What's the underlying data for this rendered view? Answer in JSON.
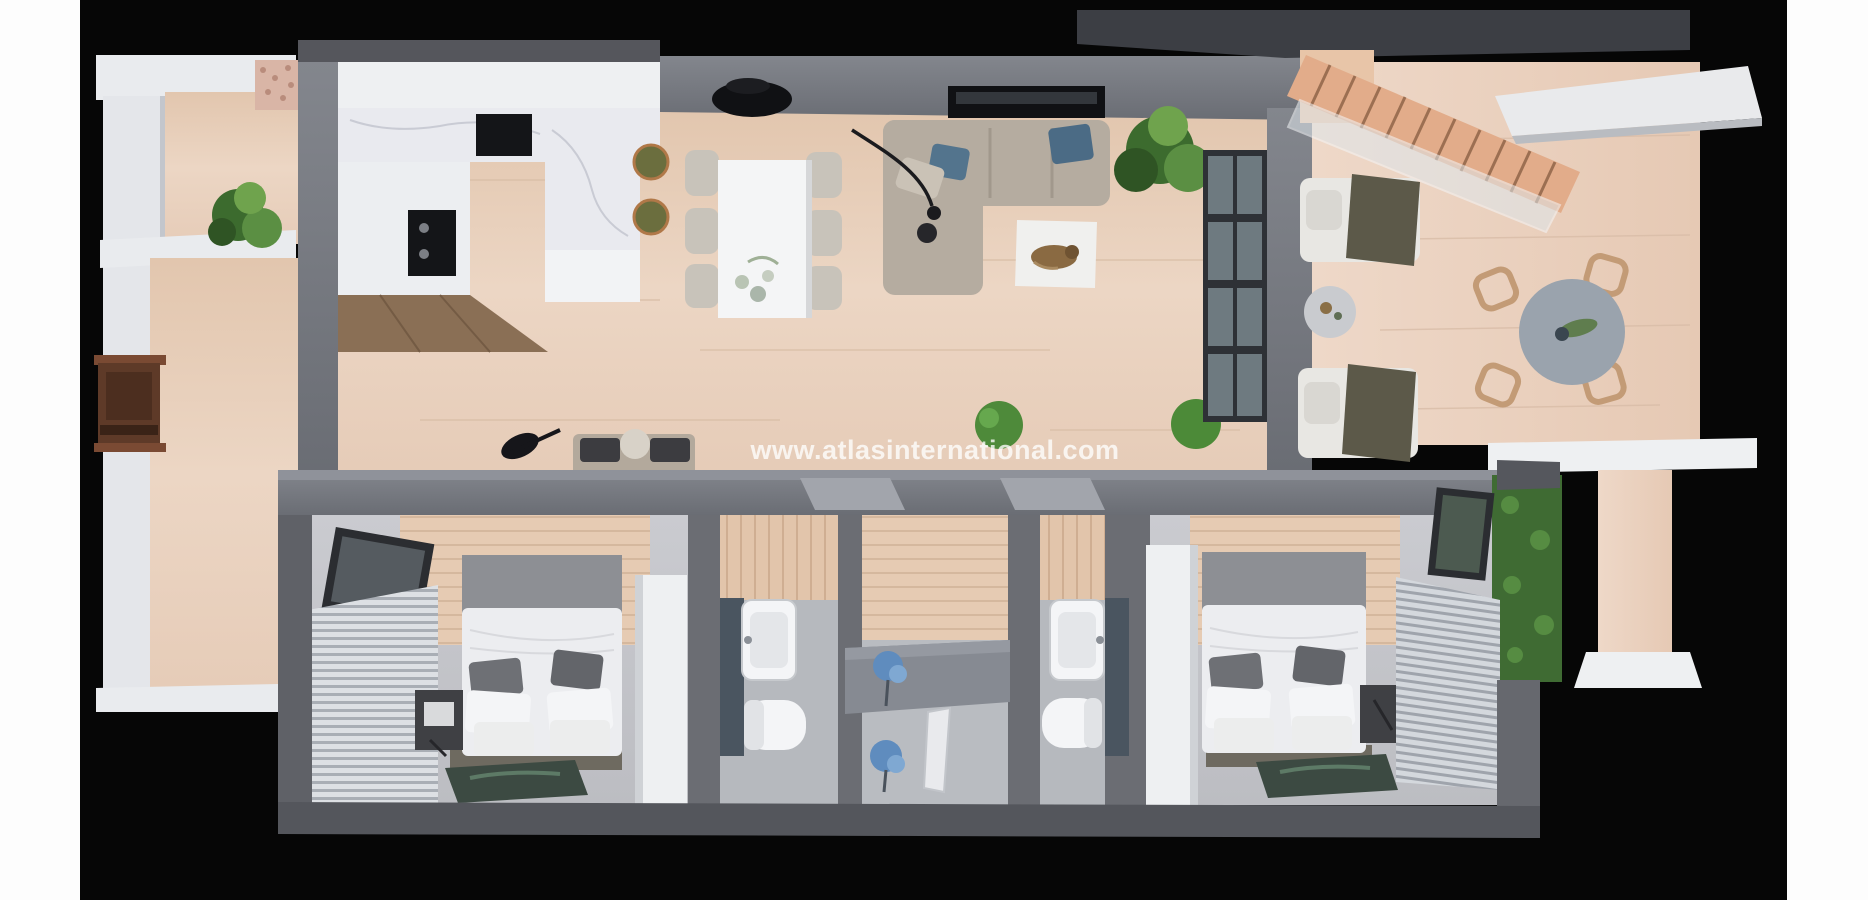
{
  "watermark": {
    "text": "www.atlasinternational.com"
  },
  "scene": {
    "description": "3D top-down cutaway render of a two-bedroom apartment with side balcony, right terrace and staircase",
    "background_color": "#060606",
    "page_margin_color": "#ffffff",
    "wood_floor_color": "#e9d2bf",
    "terrace_wood_color": "#eed8c8",
    "bedroom_floor_color": "#c6c7cb",
    "bathroom_floor_color": "#b6b9be",
    "wall_color": "#73767d",
    "wall_dark_color": "#54565c",
    "white_cabinet_color": "#eef0f2",
    "marble_color": "#e9eaef",
    "stair_wood_color": "#e2ac8a",
    "sofa_color": "#b5aca0",
    "pillow_blue_color": "#53748d",
    "plant_green_color": "#4e8a3a",
    "hedge_green_color": "#3f6b33",
    "stool_olive_color": "#6b6e3e",
    "door_brown_color": "#5e3a28",
    "flower_blue_color": "#5f8cbe"
  },
  "rooms": [
    {
      "name": "kitchen",
      "furniture": [
        "l-shaped-counter",
        "wall-cabinets",
        "cooktop",
        "oven",
        "marble-island",
        "two-bar-stools",
        "wood-base-cabinets"
      ]
    },
    {
      "name": "dining-area",
      "furniture": [
        "rectangular-white-table",
        "six-chairs",
        "black-ceiling-lamp",
        "table-flowers"
      ]
    },
    {
      "name": "living-room",
      "furniture": [
        "l-shaped-sofa",
        "blue-cushions",
        "wall-tv",
        "arc-floor-lamp",
        "white-rug-with-dog",
        "corner-plant",
        "small-plant",
        "bench-with-guitar",
        "sliding-glass-door",
        "wall-mirror"
      ]
    },
    {
      "name": "terrace-right",
      "furniture": [
        "wood-staircase",
        "glass-railing",
        "upper-landing",
        "white-roof-slab",
        "two-sun-loungers",
        "round-side-table",
        "round-dining-table",
        "four-wicker-chairs",
        "parapet-wall",
        "lower-deck"
      ]
    },
    {
      "name": "balcony-left",
      "furniture": [
        "white-parapet-walls",
        "entrance-door",
        "potted-plant",
        "pebble-strip",
        "wood-decking"
      ]
    },
    {
      "name": "bedroom-left",
      "furniture": [
        "double-bed",
        "canopy-headboard",
        "nightstand",
        "picture-rug",
        "white-wardrobe",
        "window",
        "louver-blinds"
      ]
    },
    {
      "name": "bathroom-left",
      "furniture": [
        "washbasin",
        "toilet",
        "mosaic-wall",
        "wood-panel-wall"
      ]
    },
    {
      "name": "hallway",
      "furniture": [
        "console-table",
        "blue-flower-vase-top",
        "blue-flower-vase-floor",
        "white-door-leaf"
      ]
    },
    {
      "name": "bathroom-right",
      "furniture": [
        "washbasin",
        "toilet",
        "mosaic-wall",
        "wood-panel-wall"
      ]
    },
    {
      "name": "bedroom-right",
      "furniture": [
        "double-bed",
        "canopy-headboard",
        "nightstand",
        "picture-rug",
        "white-wardrobe",
        "window",
        "louver-blinds",
        "green-wall-outside"
      ]
    }
  ]
}
